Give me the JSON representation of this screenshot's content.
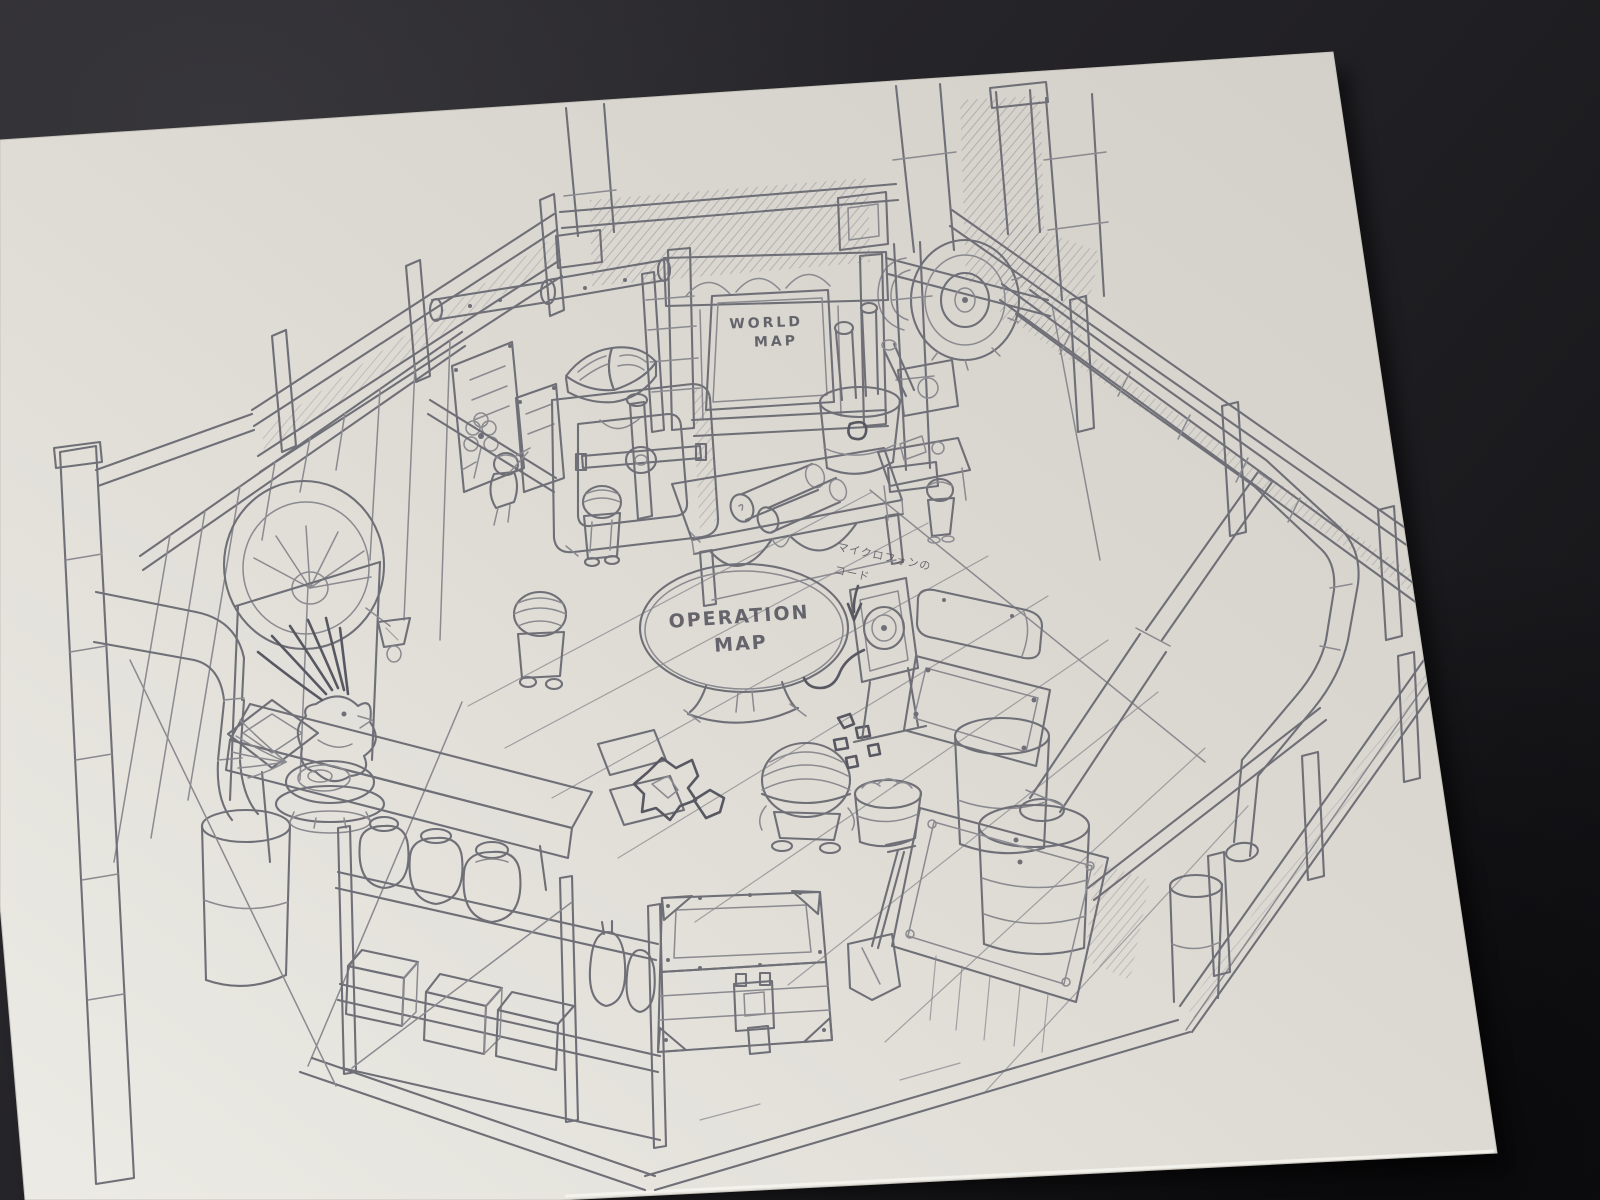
{
  "scene": {
    "description": "Photograph of a graphite pencil concept sketch of an isometric hideout room, drawn on a white sheet lying on a dark slate surface",
    "background_color": "#232226",
    "paper_color": "#dfdcd5",
    "pencil_color": "#6f6f77"
  },
  "labels": {
    "world_map_sign": {
      "line1": "WORLD",
      "line2": "MAP"
    },
    "operation_map_table": {
      "line1": "OPERATION",
      "line2": "MAP"
    },
    "annotation_mic_cord": {
      "line1": "マイクロフォンの",
      "line2": "コード"
    }
  },
  "depicted_objects": [
    "wooden fence rails and corner posts",
    "chimney pipes",
    "jointed bamboo-style pipe",
    "world map notice board with carved arches",
    "ladder frame",
    "open book on safe",
    "safe with cross-shaped handle",
    "desk with rolled map scrolls",
    "bucket of rolled maps",
    "oval operation map table on pedestal",
    "small crew characters with striped bandanas",
    "arched fan window and panel door with diamond motif",
    "notice board with flower",
    "hanging lamp",
    "chocobo statue on shell base",
    "side table slab",
    "storage shelf with jars, crates and bottles",
    "riveted travel chest with latch",
    "shovel",
    "basket of coal",
    "crumpled papers and loose sheets",
    "microphone in frame stand with cord",
    "horizontal tank",
    "two boilers on riveted base plate",
    "large segmented pipes",
    "plank floor"
  ]
}
